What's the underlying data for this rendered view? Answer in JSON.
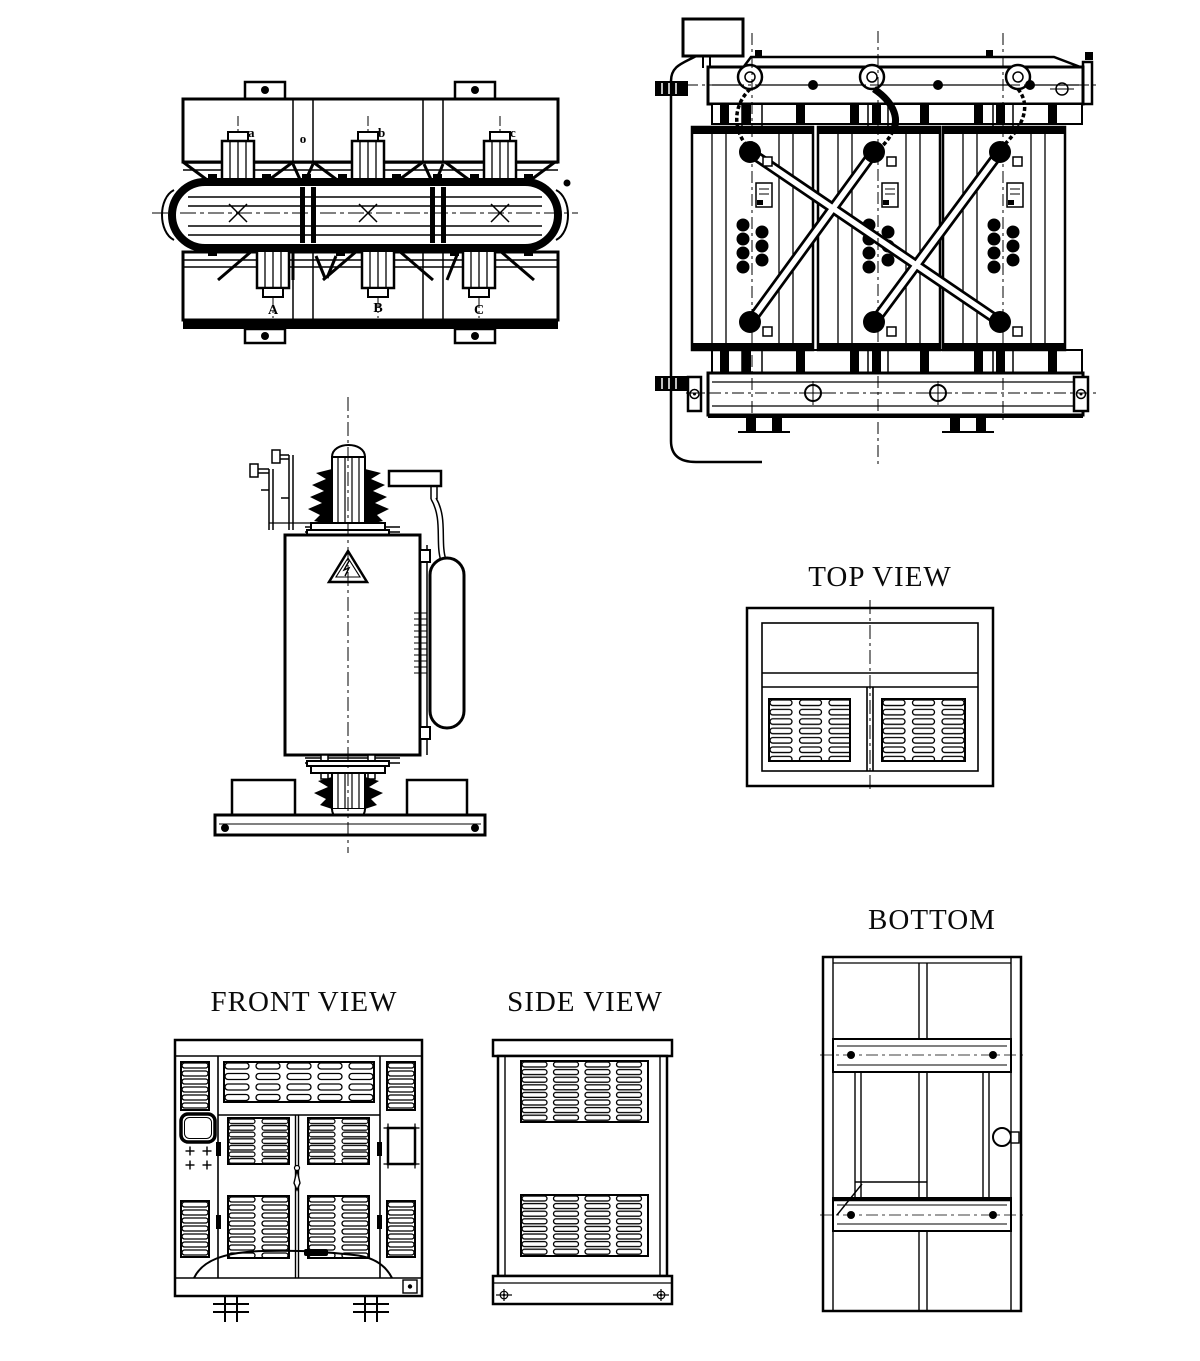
{
  "sheet": {
    "background": "#ffffff",
    "ink": "#000000"
  },
  "labels": {
    "top_view": "TOP VIEW",
    "bottom": "BOTTOM",
    "front_view": "FRONT VIEW",
    "side_view": "SIDE VIEW"
  },
  "core_plan": {
    "top_terminals": [
      "a",
      "o",
      "b",
      "c"
    ],
    "bottom_terminals": [
      "A",
      "B",
      "C"
    ]
  }
}
